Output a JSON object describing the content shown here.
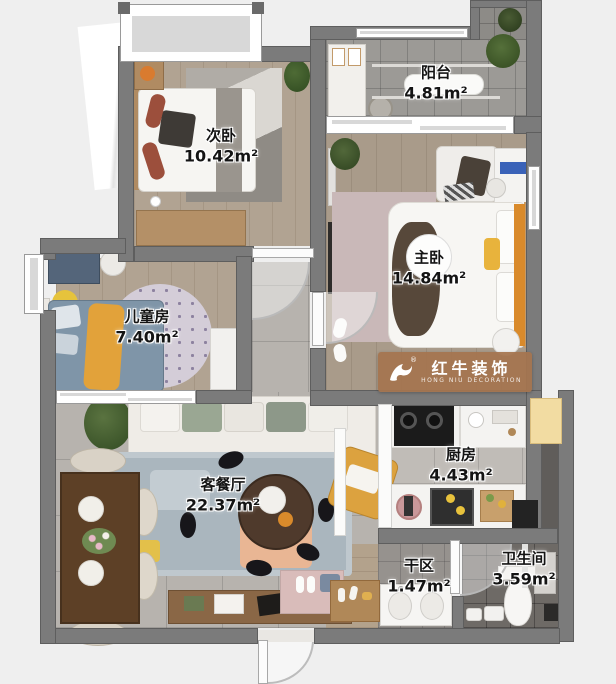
{
  "plan": {
    "background": "#efefef",
    "wall_color": "#7b7b7b",
    "rooms": [
      {
        "id": "secondary-bedroom",
        "name": "次卧",
        "area": "10.42m²",
        "floor": "wood"
      },
      {
        "id": "balcony",
        "name": "阳台",
        "area": "4.81m²",
        "floor": "tile"
      },
      {
        "id": "master-bedroom",
        "name": "主卧",
        "area": "14.84m²",
        "floor": "wood"
      },
      {
        "id": "kids-room",
        "name": "儿童房",
        "area": "7.40m²",
        "floor": "wood"
      },
      {
        "id": "living-dining",
        "name": "客餐厅",
        "area": "22.37m²",
        "floor": "tile"
      },
      {
        "id": "kitchen",
        "name": "厨房",
        "area": "4.43m²",
        "floor": "tile"
      },
      {
        "id": "dry-area",
        "name": "干区",
        "area": "1.47m²",
        "floor": "tile"
      },
      {
        "id": "bathroom",
        "name": "卫生间",
        "area": "3.59m²",
        "floor": "tile"
      }
    ],
    "watermark": {
      "brand": "红牛装饰",
      "brand_en": "HONG NIU DECORATION",
      "registered": "®"
    }
  }
}
